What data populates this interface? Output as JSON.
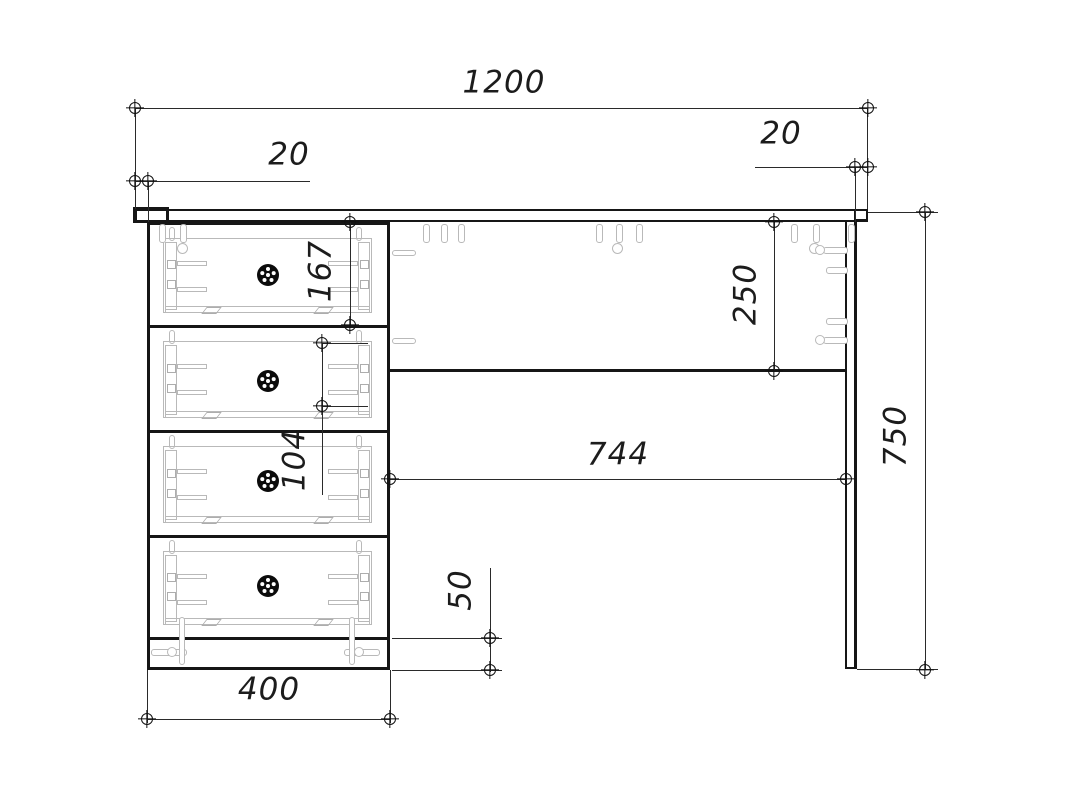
{
  "drawing": {
    "kind": "furniture-technical-drawing",
    "subject": "single-pedestal desk front elevation with four drawers",
    "units": "mm",
    "colors": {
      "line": "#161616",
      "dimension_line": "#2a2a2a",
      "hardware": "#b9b9b9",
      "background": "#ffffff",
      "knob": "#0b0b0b"
    }
  },
  "dimensions": {
    "total_width": {
      "value": "1200",
      "orientation": "horizontal"
    },
    "left_overhang": {
      "value": "20",
      "orientation": "horizontal"
    },
    "right_overhang": {
      "value": "20",
      "orientation": "horizontal"
    },
    "drawer_front_height": {
      "value": "167",
      "orientation": "vertical"
    },
    "drawer_pitch": {
      "value": "104",
      "orientation": "vertical"
    },
    "apron_height": {
      "value": "250",
      "orientation": "vertical"
    },
    "kneehole_width": {
      "value": "744",
      "orientation": "horizontal"
    },
    "overall_height": {
      "value": "750",
      "orientation": "vertical"
    },
    "plinth_height": {
      "value": "50",
      "orientation": "vertical"
    },
    "pedestal_width": {
      "value": "400",
      "orientation": "horizontal"
    }
  },
  "parts": {
    "drawer_count": 4,
    "knob_count": 4
  }
}
